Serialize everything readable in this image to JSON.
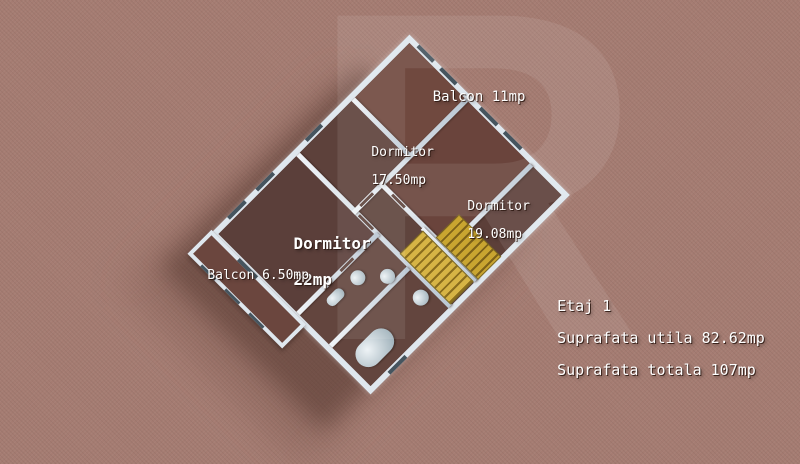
{
  "scene": {
    "type": "3d-floor-plan-render",
    "background_color": "#a57c72",
    "floor_color": "#5e423c",
    "wall_color": "#dfe7ee",
    "stair_color": "#c9a530",
    "label_color": "#ffffff",
    "watermark_letter": "R"
  },
  "rooms": {
    "balcon11": {
      "label": "Balcon 11mp"
    },
    "dormitor1750": {
      "name": "Dormitor",
      "area": "17.50mp"
    },
    "dormitor1908": {
      "name": "Dormitor",
      "area": "19.08mp"
    },
    "dormitor22": {
      "name": "Dormitor",
      "area": "22mp"
    },
    "balcon650": {
      "label": "Balcon 6.50mp"
    }
  },
  "info": {
    "floor": "Etaj 1",
    "usable_area": "Suprafata utila 82.62mp",
    "total_area": "Suprafata totala 107mp"
  }
}
